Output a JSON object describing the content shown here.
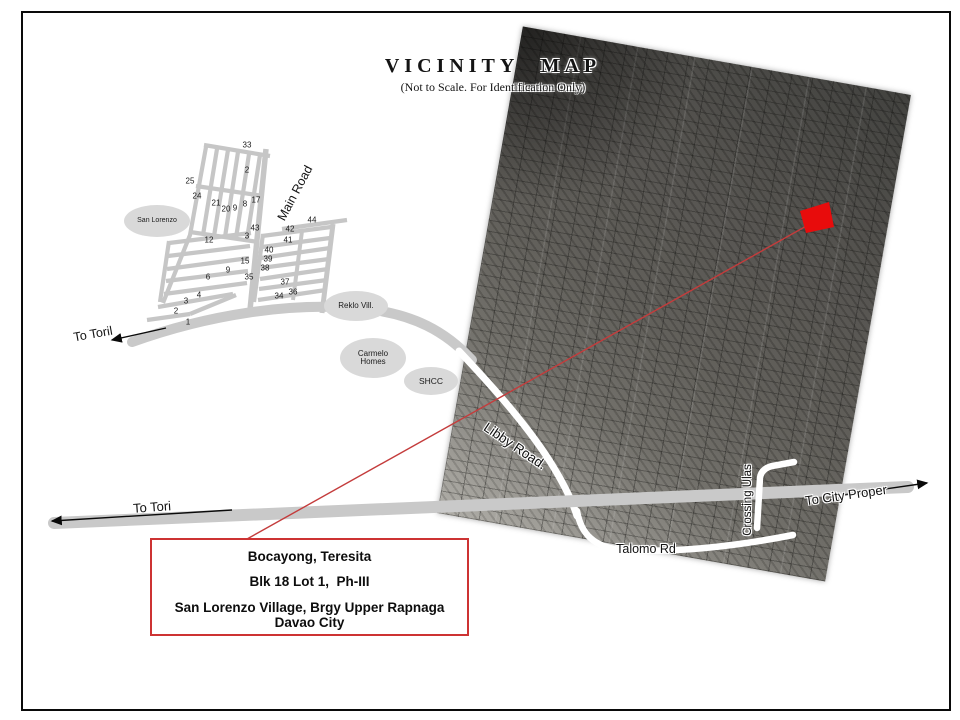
{
  "page": {
    "title": "VICINITY MAP",
    "subtitle": "(Not to Scale. For Identification Only)"
  },
  "info_box": {
    "line1": "Bocayong, Teresita",
    "line2": "Blk 18 Lot 1,  Ph-III",
    "line3": "San Lorenzo Village, Brgy Upper Rapnaga",
    "line4": "Davao City"
  },
  "places": {
    "san_lorenzo": "San Lorenzo",
    "reklo": "Reklo Vill.",
    "carmelo_line1": "Carmelo",
    "carmelo_line2": "Homes",
    "shcc": "SHCC"
  },
  "roads": {
    "main_road": "Main Road",
    "libby": "Libby Road.",
    "talomo": "Talomo Rd",
    "crossing_ulas": "Crossing Ulas",
    "to_toril": "To Toril",
    "to_tori": "To Tori",
    "to_city_proper": "To City Proper"
  },
  "colors": {
    "marker_red": "#e80c0c",
    "line_red": "#c43c3c",
    "box_border_red": "#cd3333",
    "road_gray": "#c9c9c9",
    "street_gray": "#c6c6c6"
  },
  "lot_numbers": [
    {
      "n": "33",
      "x": 247,
      "y": 145
    },
    {
      "n": "2",
      "x": 247,
      "y": 170
    },
    {
      "n": "25",
      "x": 190,
      "y": 181
    },
    {
      "n": "24",
      "x": 197,
      "y": 196
    },
    {
      "n": "21",
      "x": 216,
      "y": 203
    },
    {
      "n": "20",
      "x": 226,
      "y": 209
    },
    {
      "n": "9",
      "x": 235,
      "y": 208
    },
    {
      "n": "8",
      "x": 245,
      "y": 204
    },
    {
      "n": "17",
      "x": 256,
      "y": 200
    },
    {
      "n": "43",
      "x": 255,
      "y": 228
    },
    {
      "n": "3",
      "x": 247,
      "y": 236
    },
    {
      "n": "44",
      "x": 312,
      "y": 220
    },
    {
      "n": "42",
      "x": 290,
      "y": 229
    },
    {
      "n": "41",
      "x": 288,
      "y": 240
    },
    {
      "n": "40",
      "x": 269,
      "y": 250
    },
    {
      "n": "39",
      "x": 268,
      "y": 259
    },
    {
      "n": "38",
      "x": 265,
      "y": 268
    },
    {
      "n": "15",
      "x": 245,
      "y": 261
    },
    {
      "n": "35",
      "x": 249,
      "y": 277
    },
    {
      "n": "37",
      "x": 285,
      "y": 282
    },
    {
      "n": "36",
      "x": 293,
      "y": 292
    },
    {
      "n": "34",
      "x": 279,
      "y": 296
    },
    {
      "n": "12",
      "x": 209,
      "y": 240
    },
    {
      "n": "9",
      "x": 228,
      "y": 270
    },
    {
      "n": "6",
      "x": 208,
      "y": 277
    },
    {
      "n": "4",
      "x": 199,
      "y": 295
    },
    {
      "n": "3",
      "x": 186,
      "y": 301
    },
    {
      "n": "2",
      "x": 176,
      "y": 311
    },
    {
      "n": "1",
      "x": 188,
      "y": 322
    }
  ]
}
